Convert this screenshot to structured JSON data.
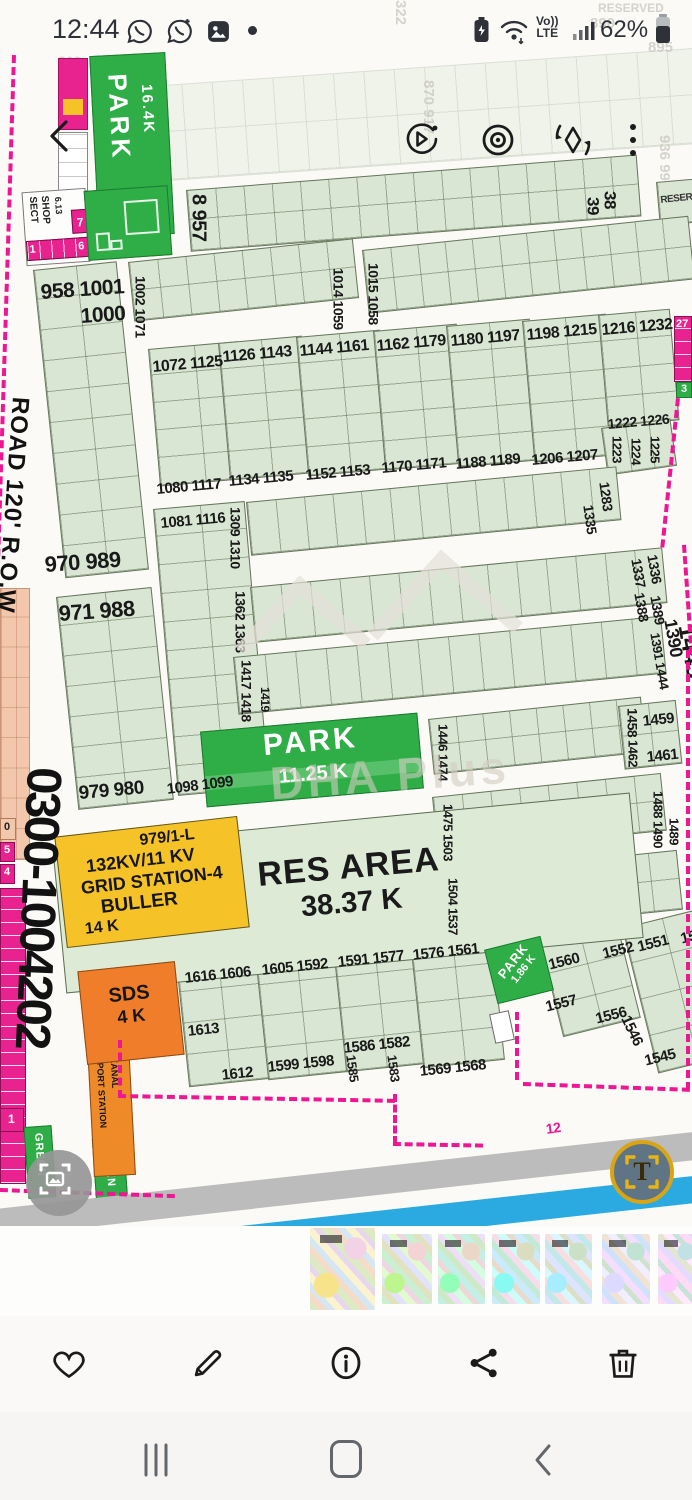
{
  "status_bar": {
    "time": "12:44",
    "volte_top": "Vo))",
    "volte_bottom": "LTE",
    "battery_percent": "62%"
  },
  "map": {
    "phone_number": "0300-1004202",
    "road_label": "ROAD 120' R.O.W",
    "reserved_label": "RESERVED",
    "res_area": {
      "title": "RES AREA",
      "size": "38.37 K"
    },
    "grid_station": {
      "line1": "979/1-L",
      "line2": "132KV/11 KV",
      "line3": "GRID STATION-4",
      "line4": "BULLER",
      "line5": "14 K"
    },
    "park_top": {
      "name": "PARK",
      "size": "16.4K"
    },
    "park_main": {
      "name": "PARK",
      "size": "11.25 K"
    },
    "park_small": {
      "name": "PARK",
      "size": "1.86 K"
    },
    "sds": {
      "name": "SDS",
      "size": "4 K"
    },
    "transport": {
      "line1": "TRANSPORT STATION",
      "line2": "9.88 KANAL"
    },
    "sector_shop": {
      "line1": "SECT",
      "line2": "SHOP",
      "size": "6.13",
      "cell1": "1",
      "cell6": "6",
      "cell7": "7"
    },
    "green_strip_1": "GREEN",
    "green_strip_2": "GREEN",
    "edge_labels": {
      "right_27": "27",
      "right_3": "3",
      "left_5": "5",
      "left_4": "4",
      "left_0": "0",
      "left_1": "1",
      "road_12": "12"
    },
    "watermark": {
      "brand": "DHA Plus",
      "phase_text": "A PHASE-10"
    },
    "plot_labels": [
      {
        "t": "8 957",
        "x": 188,
        "y": 194,
        "s": 20,
        "v": 1
      },
      {
        "t": "39",
        "x": 584,
        "y": 197,
        "s": 17,
        "v": 1
      },
      {
        "t": "38",
        "x": 601,
        "y": 191,
        "s": 17,
        "v": 1
      },
      {
        "t": "1002 1071",
        "x": 133,
        "y": 276,
        "s": 14,
        "v": 1
      },
      {
        "t": "1014 1059",
        "x": 331,
        "y": 268,
        "s": 14,
        "v": 1
      },
      {
        "t": "1015 1058",
        "x": 366,
        "y": 263,
        "s": 14,
        "v": 1
      },
      {
        "t": "958 1001",
        "x": 40,
        "y": 282,
        "s": 21,
        "r": -4
      },
      {
        "t": "1000",
        "x": 80,
        "y": 306,
        "s": 21,
        "r": -4
      },
      {
        "t": "970 989",
        "x": 44,
        "y": 554,
        "s": 22,
        "r": -4
      },
      {
        "t": "971 988",
        "x": 58,
        "y": 603,
        "s": 22,
        "r": -4
      },
      {
        "t": "979 980",
        "x": 78,
        "y": 784,
        "s": 19,
        "r": -5
      },
      {
        "t": "1072 1125",
        "x": 152,
        "y": 360,
        "s": 16,
        "r": -5
      },
      {
        "t": "1080 1117",
        "x": 156,
        "y": 482,
        "s": 15,
        "r": -5
      },
      {
        "t": "1081 1116",
        "x": 160,
        "y": 516,
        "s": 15,
        "r": -5
      },
      {
        "t": "1098 1099",
        "x": 166,
        "y": 782,
        "s": 15,
        "r": -7
      },
      {
        "t": "1126 1143",
        "x": 222,
        "y": 350,
        "s": 16,
        "r": -5
      },
      {
        "t": "1134 1135",
        "x": 228,
        "y": 474,
        "s": 15,
        "r": -5
      },
      {
        "t": "1144 1161",
        "x": 299,
        "y": 344,
        "s": 16,
        "r": -5
      },
      {
        "t": "1152 1153",
        "x": 305,
        "y": 468,
        "s": 15,
        "r": -5
      },
      {
        "t": "1162 1179",
        "x": 376,
        "y": 339,
        "s": 16,
        "r": -5
      },
      {
        "t": "1170 1171",
        "x": 381,
        "y": 461,
        "s": 15,
        "r": -5
      },
      {
        "t": "1180 1197",
        "x": 450,
        "y": 334,
        "s": 16,
        "r": -5
      },
      {
        "t": "1188 1189",
        "x": 455,
        "y": 457,
        "s": 15,
        "r": -5
      },
      {
        "t": "1198 1215",
        "x": 526,
        "y": 328,
        "s": 16,
        "r": -5
      },
      {
        "t": "1206 1207",
        "x": 531,
        "y": 453,
        "s": 15,
        "r": -5
      },
      {
        "t": "1216 1232",
        "x": 601,
        "y": 323,
        "s": 16,
        "r": -5
      },
      {
        "t": "1222 1226",
        "x": 607,
        "y": 417,
        "s": 14,
        "r": -5
      },
      {
        "t": "1223",
        "x": 610,
        "y": 436,
        "s": 13,
        "v": 1
      },
      {
        "t": "1224",
        "x": 629,
        "y": 438,
        "s": 13,
        "v": 1
      },
      {
        "t": "1225",
        "x": 648,
        "y": 436,
        "s": 13,
        "v": 1
      },
      {
        "t": "1309 1310",
        "x": 228,
        "y": 507,
        "s": 14,
        "v": 1
      },
      {
        "t": "1362 1363",
        "x": 233,
        "y": 591,
        "s": 14,
        "v": 1
      },
      {
        "t": "1417 1418",
        "x": 239,
        "y": 660,
        "s": 14,
        "v": 1
      },
      {
        "t": "1419",
        "x": 259,
        "y": 687,
        "s": 12,
        "v": 1
      },
      {
        "t": "1283",
        "x": 597,
        "y": 483,
        "s": 14,
        "v": 1,
        "r": -8
      },
      {
        "t": "1335",
        "x": 581,
        "y": 506,
        "s": 14,
        "v": 1,
        "r": -8
      },
      {
        "t": "1337",
        "x": 629,
        "y": 560,
        "s": 14,
        "v": 1,
        "r": -10
      },
      {
        "t": "1336",
        "x": 645,
        "y": 556,
        "s": 14,
        "v": 1,
        "r": -10
      },
      {
        "t": "1388",
        "x": 632,
        "y": 594,
        "s": 14,
        "v": 1,
        "r": -10
      },
      {
        "t": "1389",
        "x": 648,
        "y": 597,
        "s": 14,
        "v": 1,
        "r": -10
      },
      {
        "t": "1390",
        "x": 661,
        "y": 621,
        "s": 18,
        "v": 1,
        "r": -10
      },
      {
        "t": "1445",
        "x": 673,
        "y": 627,
        "s": 25,
        "v": 1,
        "r": -10
      },
      {
        "t": "1391 1444",
        "x": 648,
        "y": 634,
        "s": 13,
        "v": 1,
        "r": -10
      },
      {
        "t": "1446 1474",
        "x": 436,
        "y": 724,
        "s": 13,
        "v": 1
      },
      {
        "t": "1458",
        "x": 625,
        "y": 708,
        "s": 14,
        "v": 1
      },
      {
        "t": "1459",
        "x": 642,
        "y": 714,
        "s": 15,
        "r": -6
      },
      {
        "t": "1462",
        "x": 626,
        "y": 740,
        "s": 13,
        "v": 1
      },
      {
        "t": "1461",
        "x": 646,
        "y": 750,
        "s": 15,
        "r": -6
      },
      {
        "t": "1475 1503",
        "x": 441,
        "y": 804,
        "s": 13,
        "v": 1
      },
      {
        "t": "1488 1490",
        "x": 651,
        "y": 791,
        "s": 13,
        "v": 1
      },
      {
        "t": "1489",
        "x": 667,
        "y": 818,
        "s": 13,
        "v": 1
      },
      {
        "t": "1504 1537",
        "x": 446,
        "y": 878,
        "s": 13,
        "v": 1
      },
      {
        "t": "1616 1606",
        "x": 184,
        "y": 971,
        "s": 15,
        "r": -6
      },
      {
        "t": "1613",
        "x": 187,
        "y": 1024,
        "s": 15,
        "r": -6
      },
      {
        "t": "1612",
        "x": 221,
        "y": 1068,
        "s": 15,
        "r": -6
      },
      {
        "t": "1605 1592",
        "x": 261,
        "y": 963,
        "s": 15,
        "r": -6
      },
      {
        "t": "1599 1598",
        "x": 267,
        "y": 1060,
        "s": 15,
        "r": -6
      },
      {
        "t": "1591 1577",
        "x": 337,
        "y": 955,
        "s": 15,
        "r": -6
      },
      {
        "t": "1586 1582",
        "x": 343,
        "y": 1041,
        "s": 15,
        "r": -6
      },
      {
        "t": "1585",
        "x": 344,
        "y": 1056,
        "s": 13,
        "v": 1,
        "r": -8
      },
      {
        "t": "1583",
        "x": 385,
        "y": 1056,
        "s": 13,
        "v": 1,
        "r": -8
      },
      {
        "t": "1576 1561",
        "x": 412,
        "y": 948,
        "s": 15,
        "r": -6
      },
      {
        "t": "1569 1568",
        "x": 419,
        "y": 1064,
        "s": 15,
        "r": -6
      },
      {
        "t": "1560",
        "x": 547,
        "y": 958,
        "s": 15,
        "r": -14
      },
      {
        "t": "1552",
        "x": 601,
        "y": 947,
        "s": 15,
        "r": -14
      },
      {
        "t": "1557",
        "x": 544,
        "y": 1000,
        "s": 15,
        "r": -14
      },
      {
        "t": "1556",
        "x": 594,
        "y": 1012,
        "s": 15,
        "r": -14
      },
      {
        "t": "1551",
        "x": 636,
        "y": 940,
        "s": 15,
        "r": -14
      },
      {
        "t": "153",
        "x": 679,
        "y": 932,
        "s": 15,
        "r": -14
      },
      {
        "t": "1546",
        "x": 618,
        "y": 1020,
        "s": 15,
        "v": 1,
        "r": -26
      },
      {
        "t": "1545",
        "x": 643,
        "y": 1054,
        "s": 15,
        "r": -14
      }
    ],
    "faint_labels": [
      {
        "t": "RESERVED",
        "x": 598,
        "y": 2,
        "s": 12
      },
      {
        "t": "890",
        "x": 590,
        "y": 16,
        "s": 15
      },
      {
        "t": "895",
        "x": 648,
        "y": 40,
        "s": 15
      },
      {
        "t": "870 917",
        "x": 420,
        "y": 80,
        "s": 15,
        "v": 1
      },
      {
        "t": "936 99",
        "x": 656,
        "y": 135,
        "s": 15,
        "v": 1
      },
      {
        "t": "869",
        "x": 58,
        "y": 54,
        "s": 14
      },
      {
        "t": "322",
        "x": 392,
        "y": 0,
        "s": 15,
        "v": 1
      }
    ]
  },
  "thumbnails": {
    "count": "7"
  },
  "colors": {
    "accent_pink": "#ee1692",
    "plot_green": "#d9e6d3",
    "park_green": "#2fae47",
    "grid_yellow": "#f5c227",
    "sds_orange": "#ef7d2a",
    "canal_blue": "#2baae2"
  }
}
